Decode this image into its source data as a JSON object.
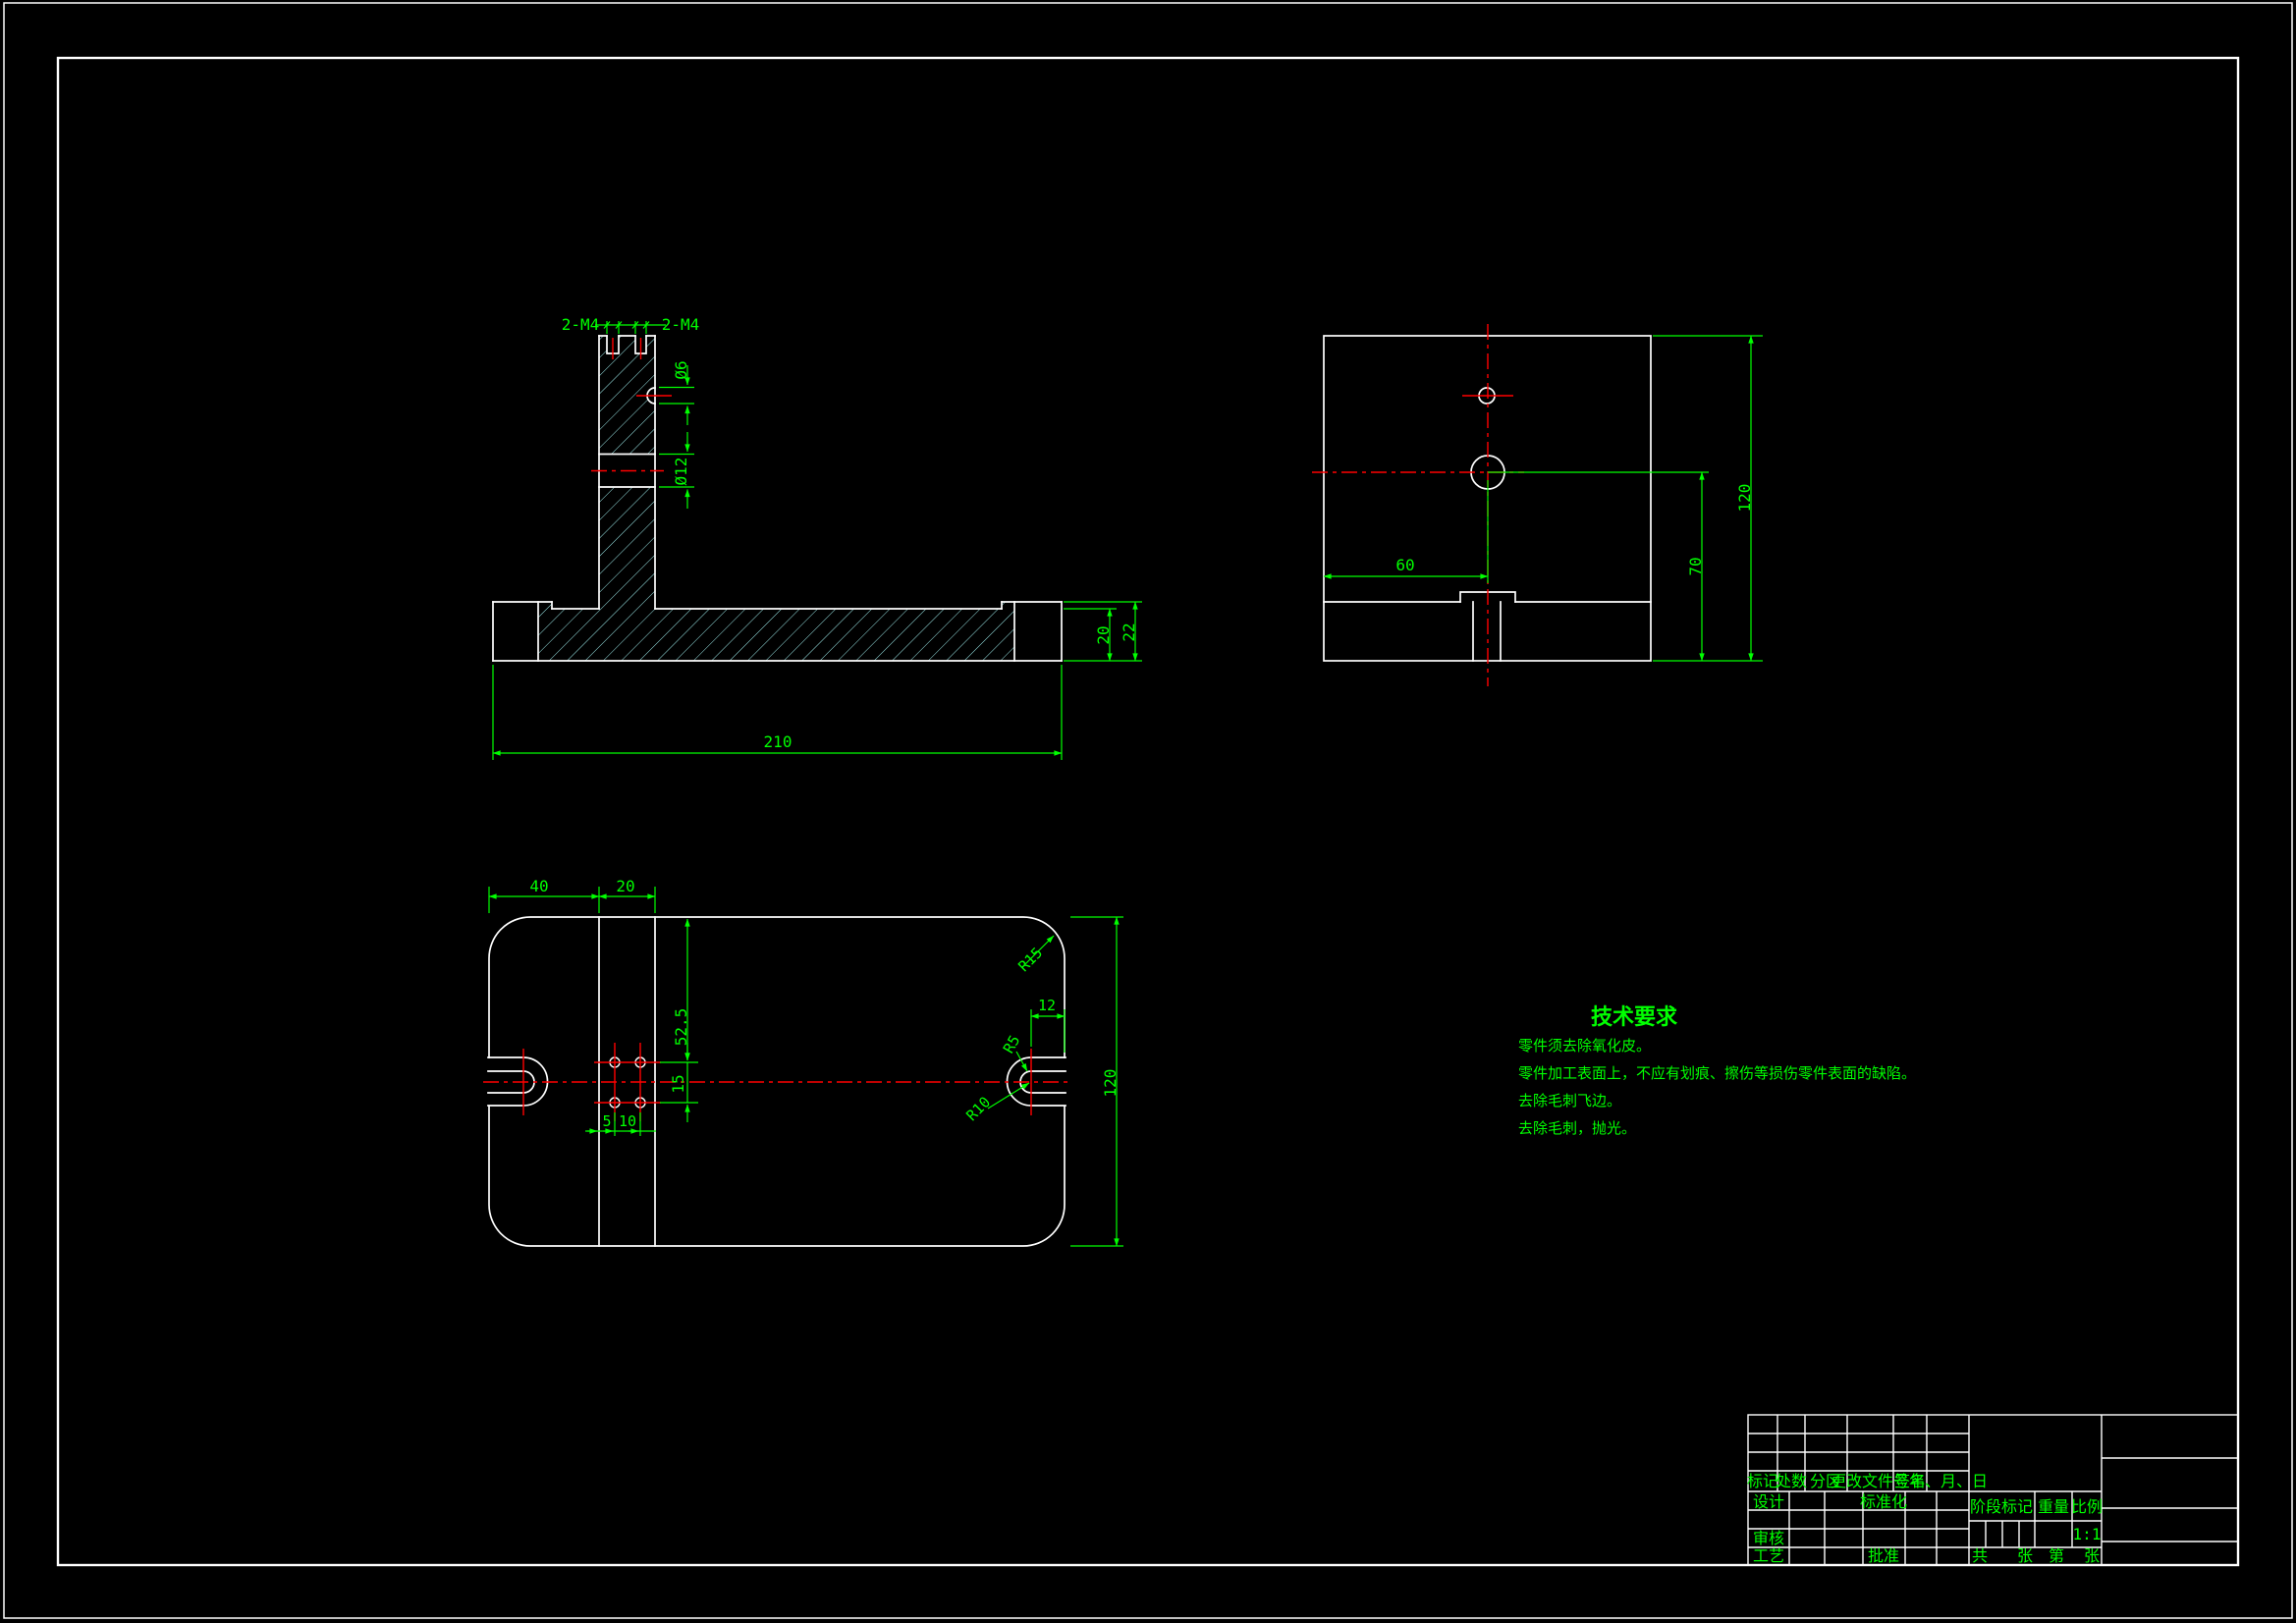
{
  "colors": {
    "background": "#000000",
    "outline": "#ffffff",
    "dimension": "#00ff00",
    "centerline": "#ff0000",
    "hatch": "#9be8e8"
  },
  "views": {
    "front_section": {
      "dims": {
        "thread_top_left": "2-M4",
        "thread_top_right": "2-M4",
        "side_hole": "Ø6",
        "cross_hole": "Ø12",
        "base_width": "210",
        "base_thickness": "20",
        "end_thickness": "22"
      }
    },
    "side": {
      "dims": {
        "hole_offset_x": "60",
        "hole_offset_y": "70",
        "depth": "120"
      }
    },
    "plan": {
      "dims": {
        "column_offset": "40",
        "column_width": "20",
        "holes_from_top": "52.5",
        "hole_row_spacing": "15",
        "hole_col_offset": "5",
        "hole_col_spacing": "10",
        "slot_center_offset": "12",
        "plate_depth": "120",
        "corner_radius": "R15",
        "slot_outer_radius": "R10",
        "slot_inner_radius": "R5"
      }
    }
  },
  "technical_requirements": {
    "title": "技术要求",
    "lines": [
      "零件须去除氧化皮。",
      "零件加工表面上，不应有划痕、擦伤等损伤零件表面的缺陷。",
      "去除毛刺飞边。",
      "去除毛刺，抛光。"
    ]
  },
  "title_block": {
    "revision_headers": [
      "标记",
      "处数",
      "分区",
      "更改文件号",
      "签名",
      "年、月、日"
    ],
    "roles": {
      "design": "设计",
      "standardization": "标准化",
      "audit": "审核",
      "process": "工艺",
      "approve": "批准"
    },
    "stage_label": "阶段标记",
    "weight_label": "重量",
    "scale_label": "比例",
    "scale_value": "1:1",
    "sheet": {
      "total_label": "共",
      "total_sheet_label": "张",
      "page_label": "第",
      "page_sheet_label": "张"
    }
  }
}
